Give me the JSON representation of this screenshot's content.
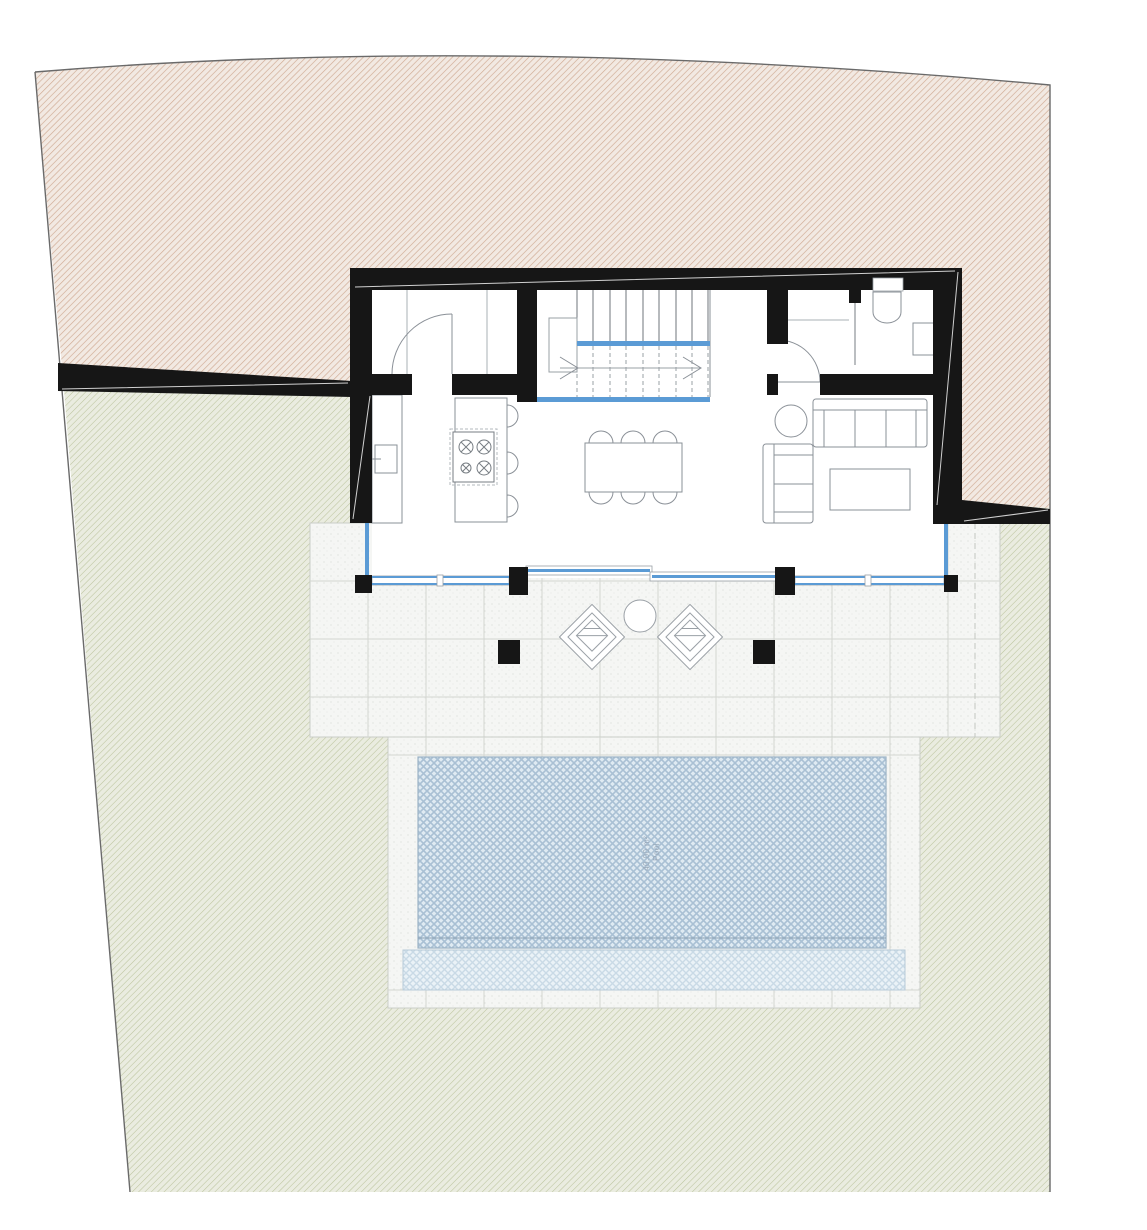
{
  "pool": {
    "name": "Pool",
    "area": "40.00 m²"
  },
  "colors": {
    "wall_black": "#161616",
    "glass_blue": "#5b9bd5",
    "parcel_north_bg": "#f2e9e2",
    "parcel_north_hatch": "#cfa992",
    "garden_bg": "#eaece0",
    "garden_hatch": "#bcc49e",
    "terrace_bg": "#f5f6f4",
    "terrace_dot": "#d8dad6",
    "grid_line": "#d3d6d1",
    "pool_bg": "#dfeaf2",
    "pool_hatch": "#a9c0d4",
    "pool_shallow_bg": "#eaf2f7",
    "pool_shallow_hatch": "#c9dae6",
    "furniture_stroke": "#8a9097",
    "boundary_line": "#6a6a6a",
    "pool_label_color": "#9aa9b9"
  }
}
